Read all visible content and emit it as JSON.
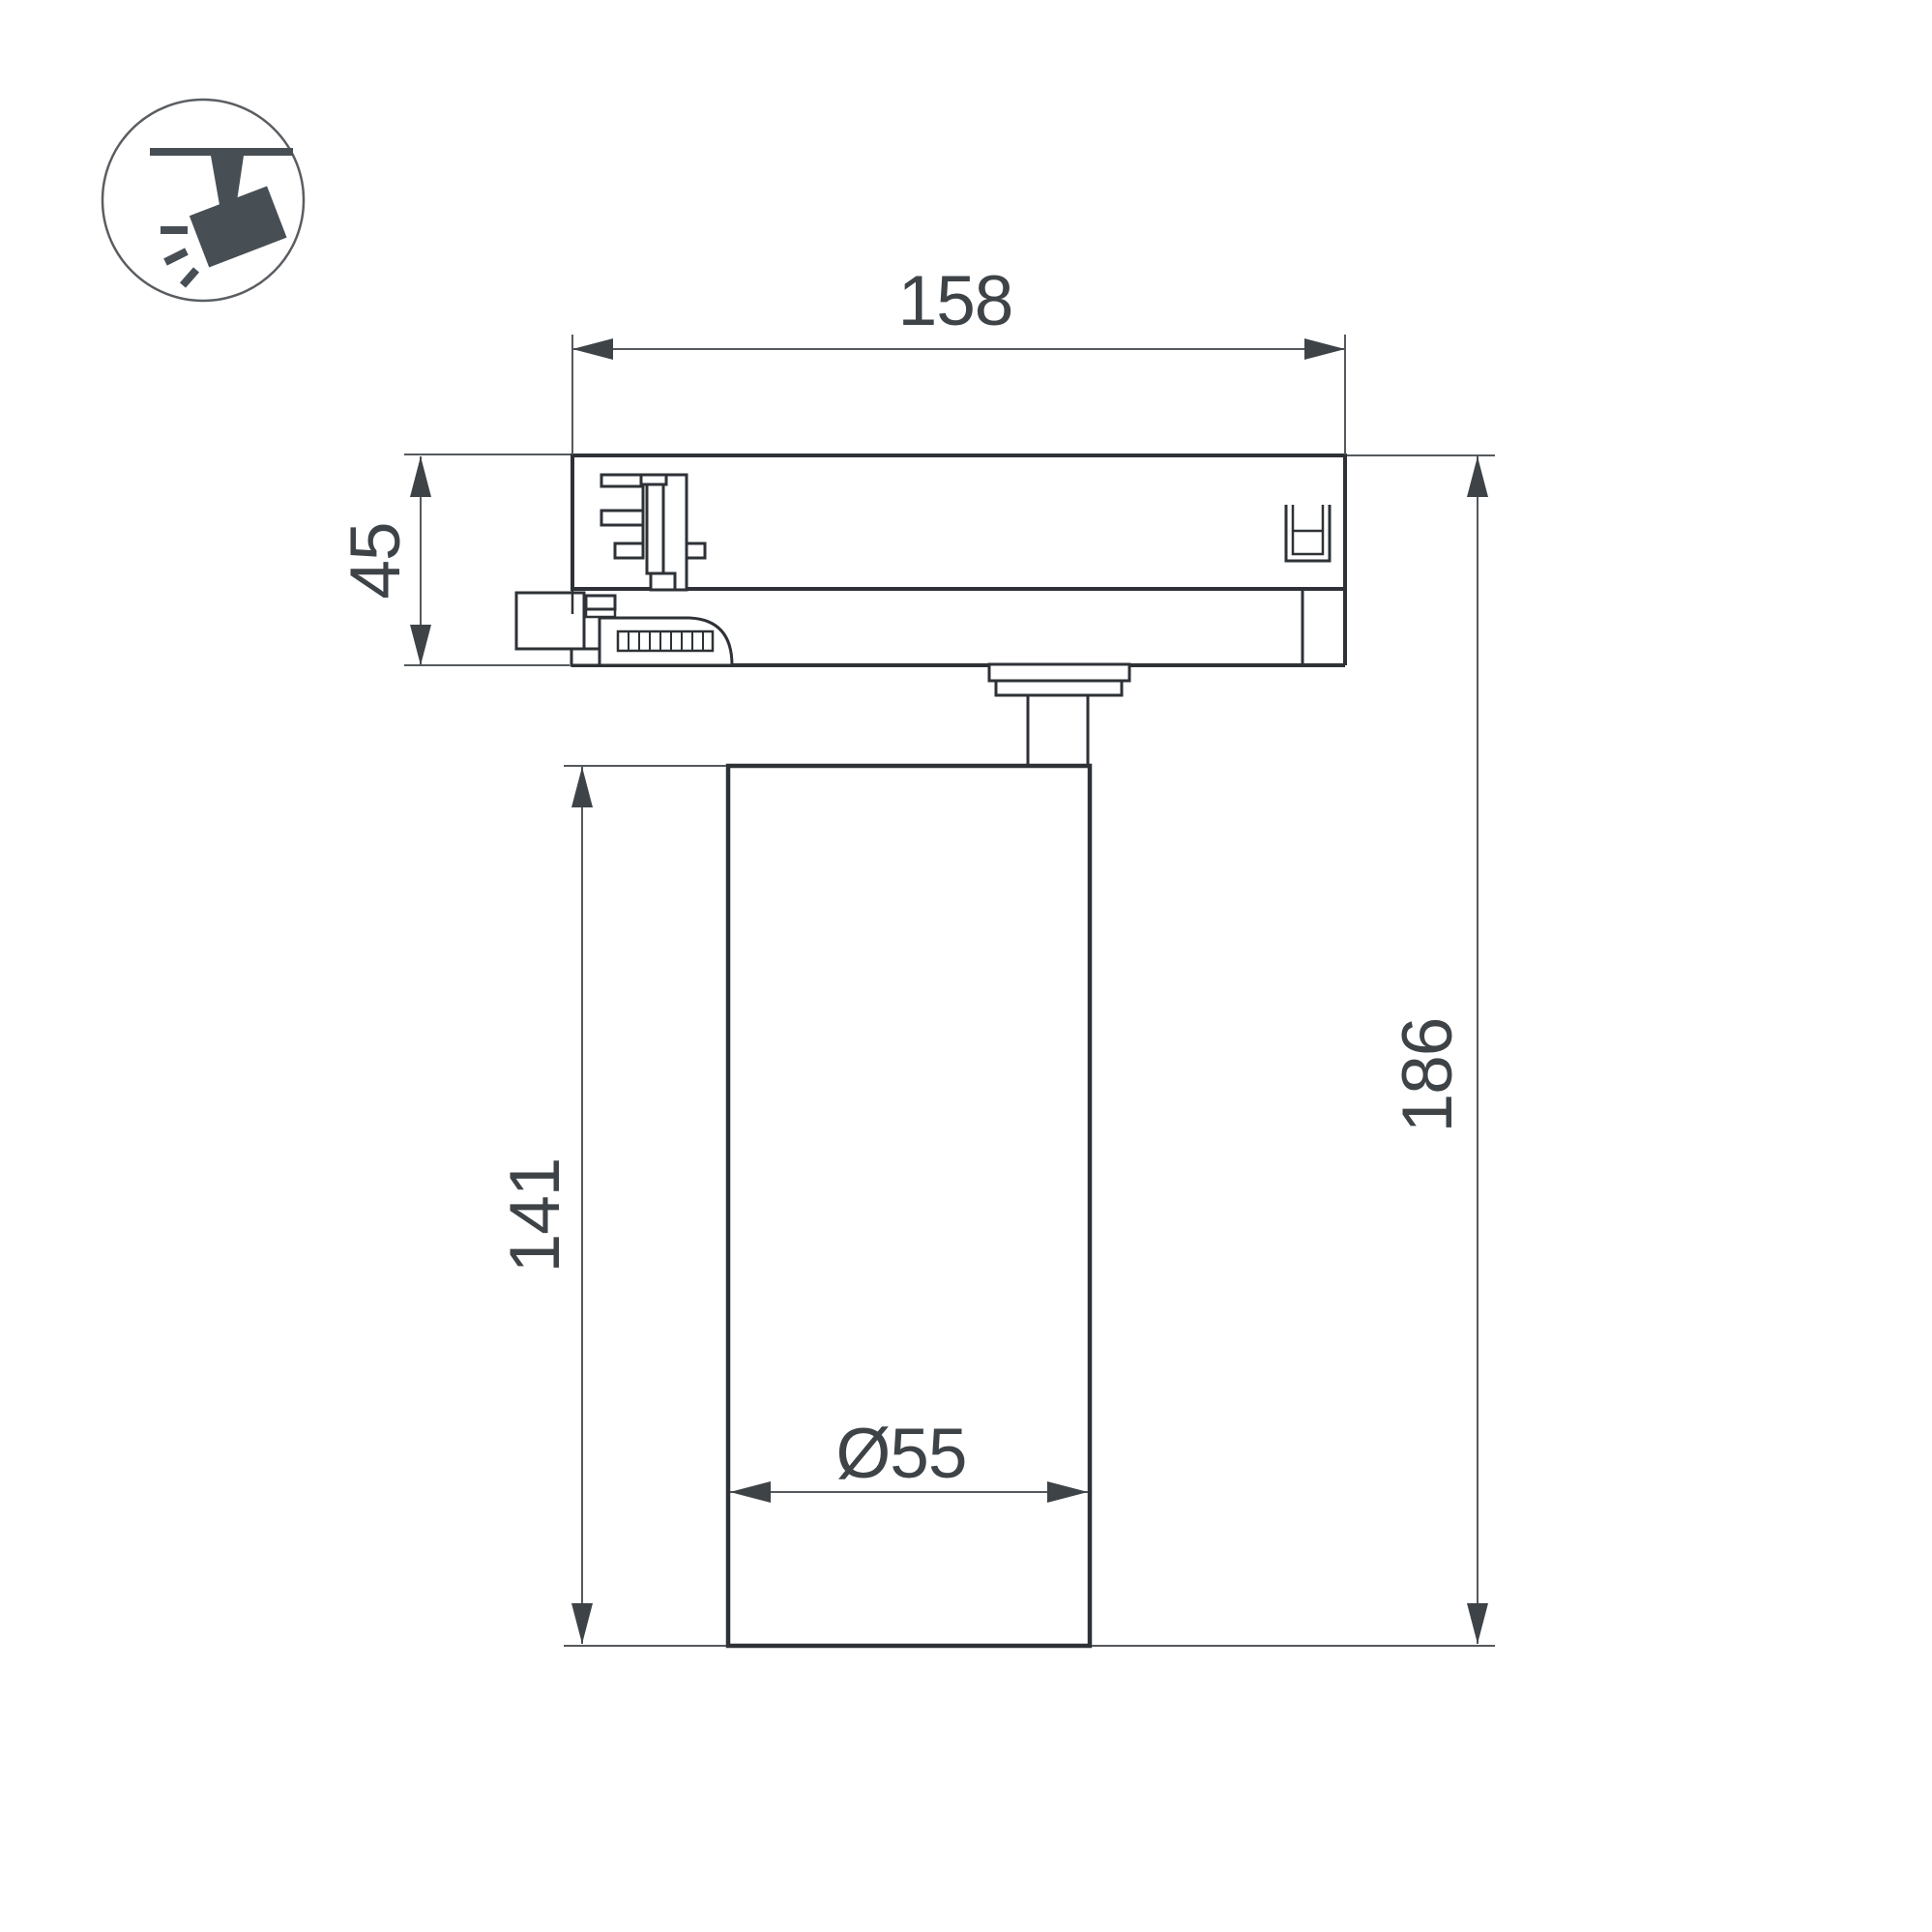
{
  "page": {
    "background": "#ffffff",
    "kind": "technical dimension drawing"
  },
  "icon_badge": {
    "name": "track-spotlight-icon",
    "description": "ceiling track spotlight pictogram in a circle"
  },
  "drawing": {
    "object": "track light fixture side view",
    "dimensions": {
      "track_adapter_width": {
        "label": "158"
      },
      "track_adapter_height": {
        "label": "45"
      },
      "lamp_body_height": {
        "label": "141"
      },
      "total_height": {
        "label": "186"
      },
      "lamp_body_diameter": {
        "label": "Ø55"
      }
    }
  },
  "colors": {
    "line-strong": "#2e3237",
    "line-medium": "#2e3237",
    "dim-line": "#55595d",
    "ink": "#3e4347",
    "icon": "#474e54",
    "paper": "#ffffff"
  }
}
